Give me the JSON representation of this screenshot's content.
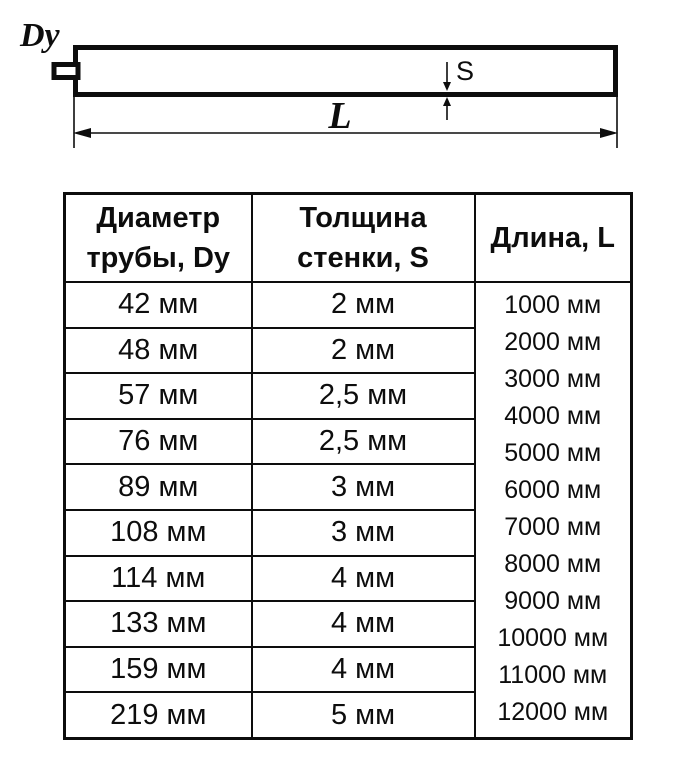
{
  "diagram": {
    "dy_label": "Dy",
    "s_label": "S",
    "l_label": "L"
  },
  "table": {
    "headers": {
      "diameter": {
        "line1": "Диаметр",
        "line2": "трубы, Dy"
      },
      "thickness": {
        "line1": "Толщина",
        "line2": "стенки, S"
      },
      "length_title": "Длина, L"
    },
    "rows": [
      {
        "diameter": "42 мм",
        "thickness": "2 мм"
      },
      {
        "diameter": "48 мм",
        "thickness": "2 мм"
      },
      {
        "diameter": "57 мм",
        "thickness": "2,5 мм"
      },
      {
        "diameter": "76 мм",
        "thickness": "2,5 мм"
      },
      {
        "diameter": "89 мм",
        "thickness": "3 мм"
      },
      {
        "diameter": "108 мм",
        "thickness": "3 мм"
      },
      {
        "diameter": "114 мм",
        "thickness": "4 мм"
      },
      {
        "diameter": "133 мм",
        "thickness": "4 мм"
      },
      {
        "diameter": "159 мм",
        "thickness": "4 мм"
      },
      {
        "diameter": "219 мм",
        "thickness": "5 мм"
      }
    ],
    "lengths": [
      "1000 мм",
      "2000 мм",
      "3000 мм",
      "4000 мм",
      "5000 мм",
      "6000 мм",
      "7000 мм",
      "8000 мм",
      "9000 мм",
      "10000 мм",
      "11000 мм",
      "12000 мм"
    ]
  },
  "colors": {
    "ink": "#0d0d0d",
    "background": "#ffffff"
  }
}
